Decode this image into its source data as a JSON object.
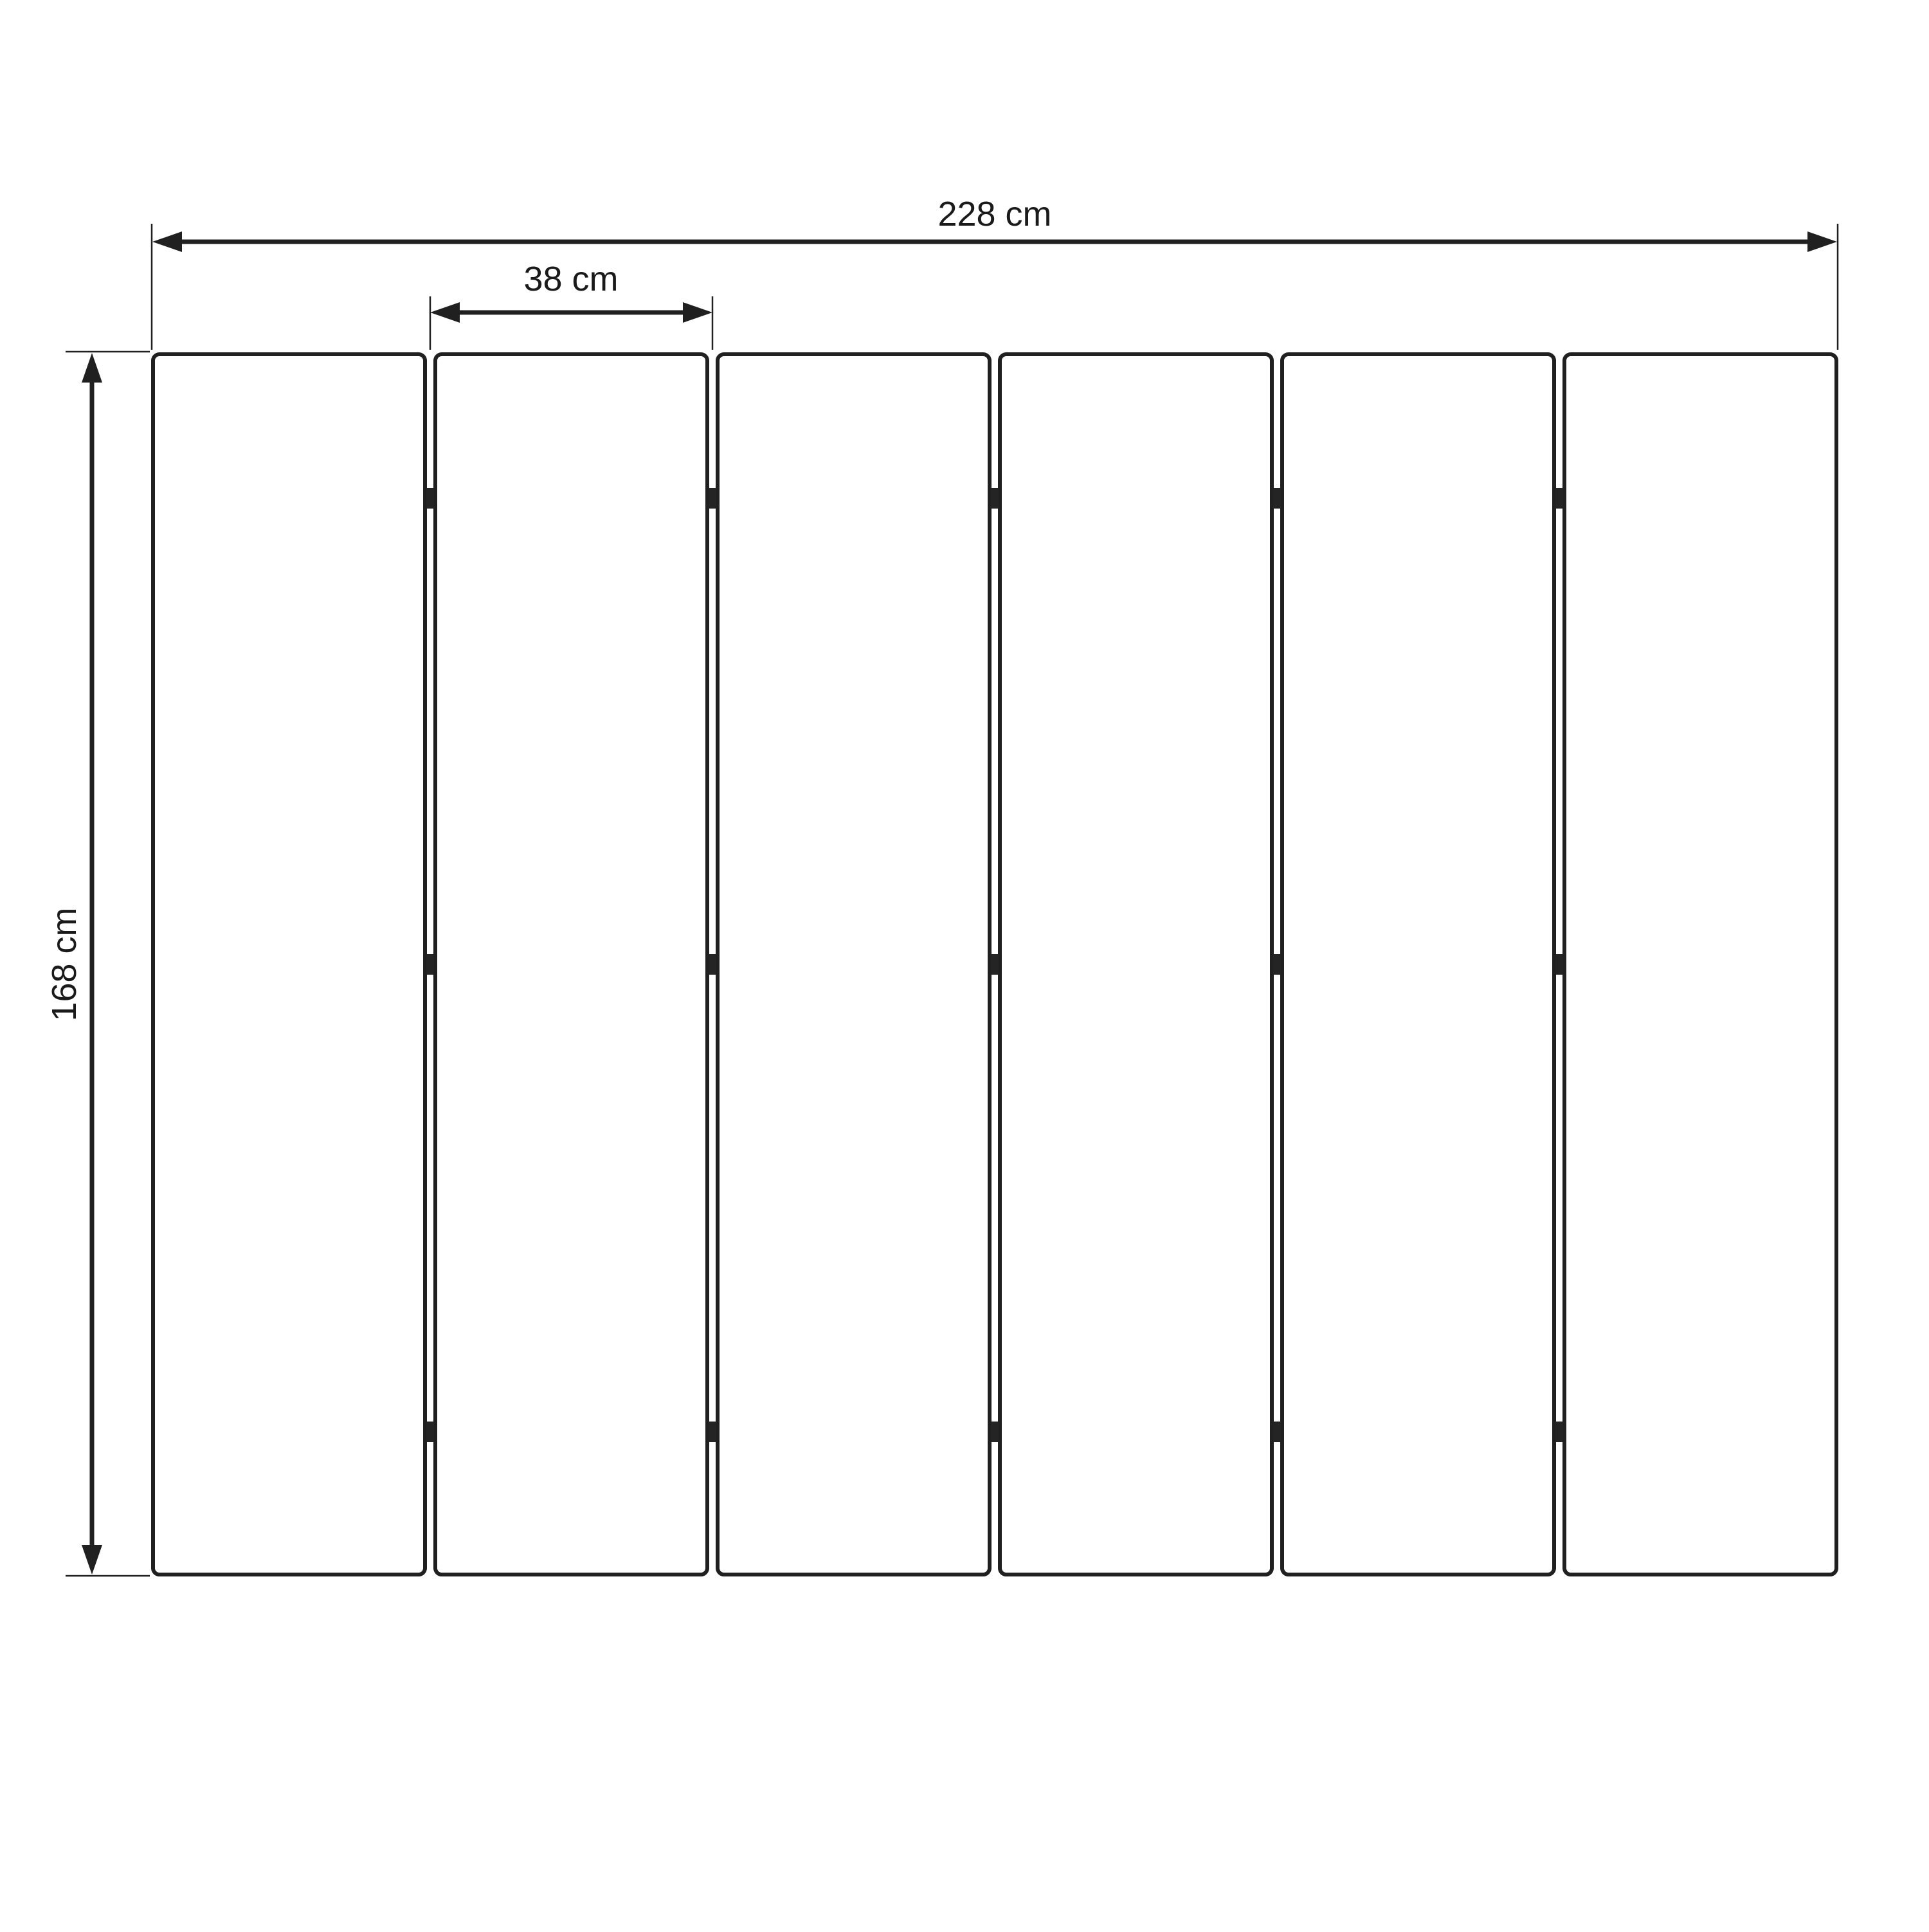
{
  "diagram": {
    "kind": "dimension-drawing",
    "structure": {
      "panel_count": 6,
      "gap_count": 5,
      "hinge_rows_per_gap": 3
    },
    "dimensions": {
      "total_width": {
        "label": "228 cm",
        "value": 228,
        "unit": "cm"
      },
      "panel_width": {
        "label": "38 cm",
        "value": 38,
        "unit": "cm"
      },
      "height": {
        "label": "168 cm",
        "value": 168,
        "unit": "cm"
      }
    },
    "colors": {
      "line": "#202020",
      "hinge": "#242424",
      "text": "#1a1a1a",
      "background": "#ffffff"
    }
  }
}
